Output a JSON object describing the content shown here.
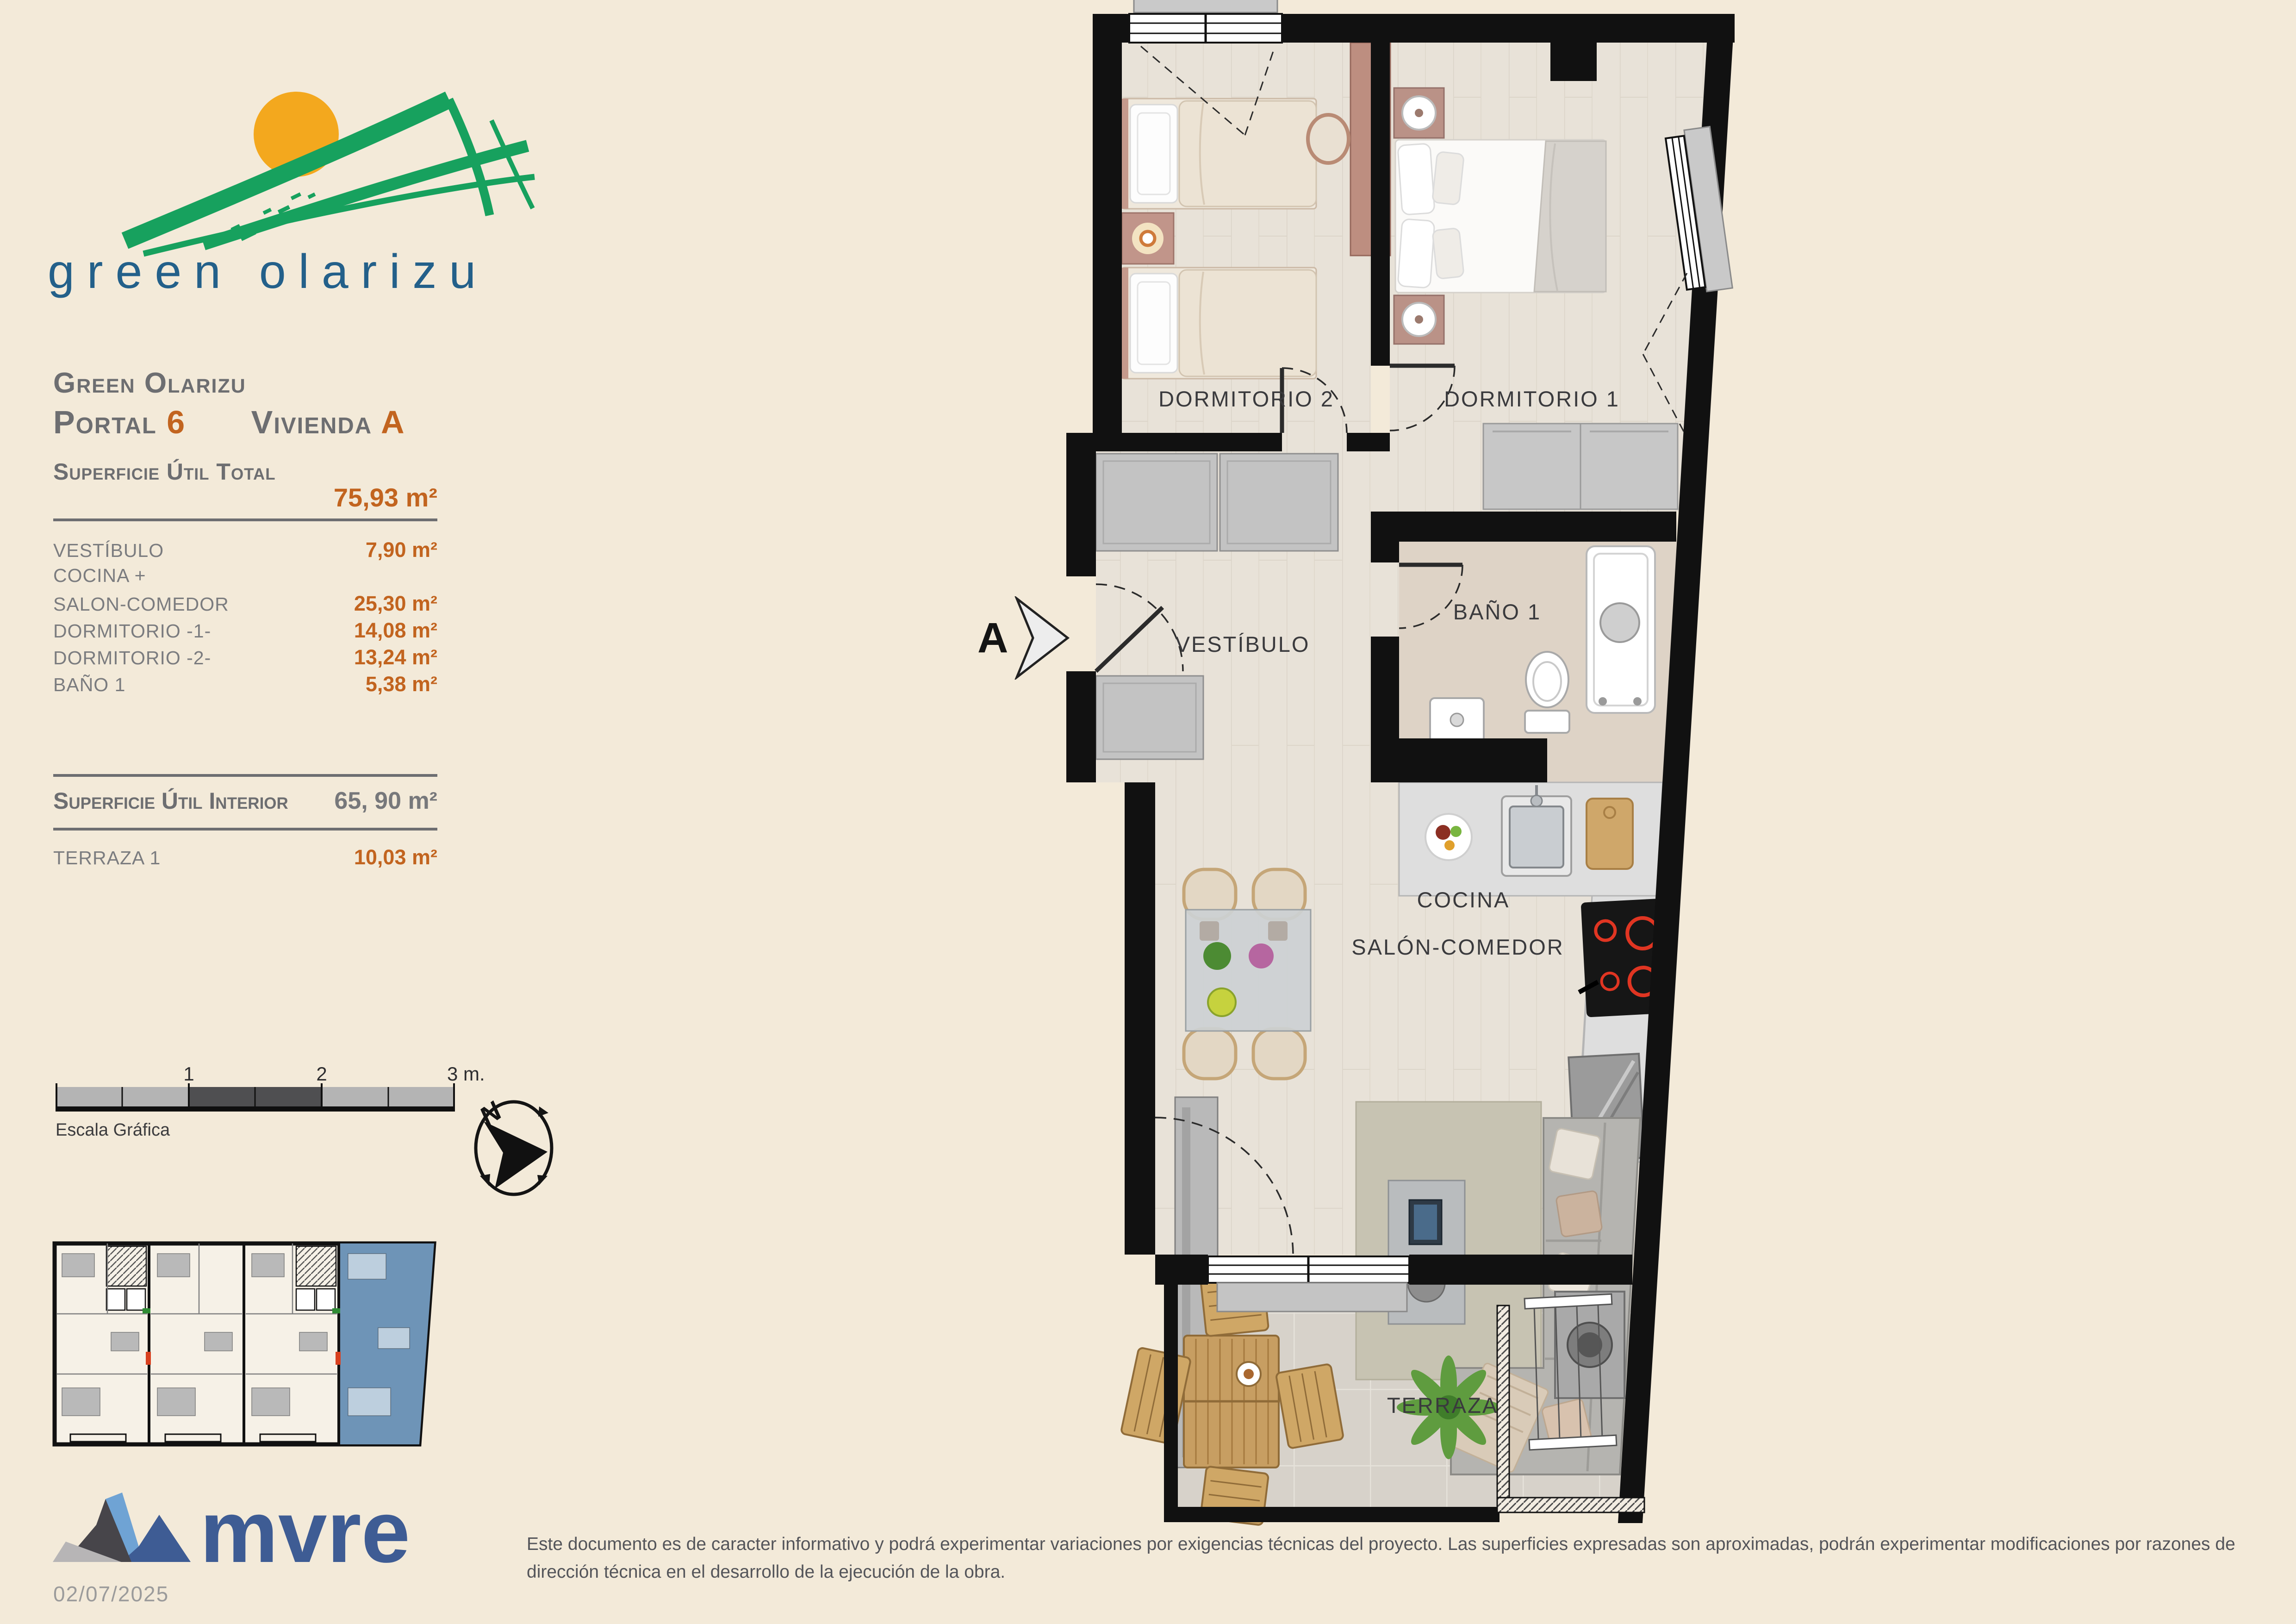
{
  "logo": {
    "wordmark": "green olarizu"
  },
  "header": {
    "project": "Green Olarizu",
    "portal_label": "Portal",
    "portal_value": "6",
    "vivienda_label": "Vivienda",
    "vivienda_value": "A"
  },
  "areas": {
    "total_label": "Superficie Útil Total",
    "total_value": "75,93 m²",
    "rows": [
      {
        "label": "VESTÍBULO",
        "value": "7,90 m²"
      },
      {
        "label": "COCINA +",
        "value": ""
      },
      {
        "label": "SALON-COMEDOR",
        "value": "25,30 m²"
      },
      {
        "label": "DORMITORIO -1-",
        "value": "14,08 m²"
      },
      {
        "label": "DORMITORIO -2-",
        "value": "13,24 m²"
      },
      {
        "label": "BAÑO 1",
        "value": "5,38 m²"
      }
    ],
    "interior_label": "Superficie Útil Interior",
    "interior_value": "65, 90 m²",
    "terrace_label": "TERRAZA 1",
    "terrace_value": "10,03 m²"
  },
  "scale_bar": {
    "label": "Escala Gráfica",
    "tick_1": "1",
    "tick_2": "2",
    "tick_3": "3 m."
  },
  "compass": {
    "north": "N"
  },
  "plan": {
    "section_marker": "A",
    "rooms": [
      {
        "label": "DORMITORIO 2"
      },
      {
        "label": "DORMITORIO 1"
      },
      {
        "label": "VESTÍBULO"
      },
      {
        "label": "BAÑO 1"
      },
      {
        "label": "COCINA"
      },
      {
        "label": "SALÓN-COMEDOR"
      },
      {
        "label": "TERRAZA"
      }
    ]
  },
  "footer": {
    "brand": "mvre",
    "date": "02/07/2025",
    "disclaimer": "Este documento es de caracter informativo y podrá experimentar variaciones por exigencias técnicas del proyecto. Las superficies expresadas son aproximadas, podrán experimentar modificaciones por razones de dirección técnica en el desarrollo de la ejecución de la obra."
  },
  "colors": {
    "background": "#f3ead9",
    "accent_orange": "#c2641f",
    "text_gray": "#6d6e71",
    "brand_blue": "#3e5c94",
    "logo_green": "#17a15e",
    "wordmark_teal": "#23608a",
    "highlight_unit_blue": "#6e94b7",
    "wall_black": "#111111"
  }
}
